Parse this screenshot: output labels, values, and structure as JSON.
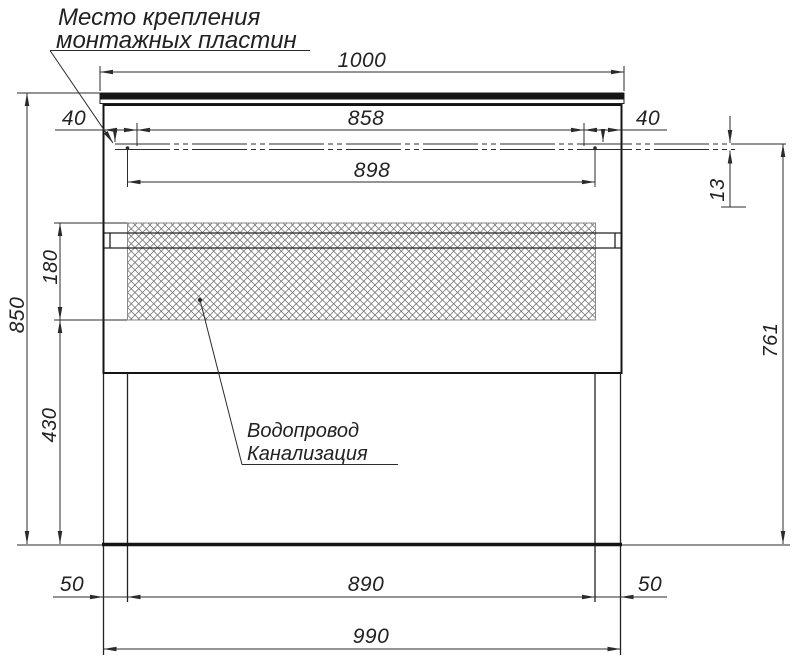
{
  "drawing": {
    "labels": {
      "mounting_note_line1": "Место крепления",
      "mounting_note_line2": "монтажных пластин",
      "utilities_line1": "Водопровод",
      "utilities_line2": "Канализация"
    },
    "dimensions": {
      "top_width": "1000",
      "side_offset_left": "40",
      "side_offset_right": "40",
      "plate_inner_span": "858",
      "plate_outer_span": "898",
      "plate_line_height": "13",
      "overall_height": "850",
      "utility_zone_height": "180",
      "zone_to_floor": "430",
      "wall_height_right": "761",
      "leg_inset_left": "50",
      "leg_inset_right": "50",
      "legs_inner_span": "890",
      "bottom_width": "990"
    },
    "colors": {
      "line": "#2b2b2b",
      "thick_line": "#141414",
      "hatch": "#6a6a6a",
      "background": "#ffffff"
    }
  }
}
